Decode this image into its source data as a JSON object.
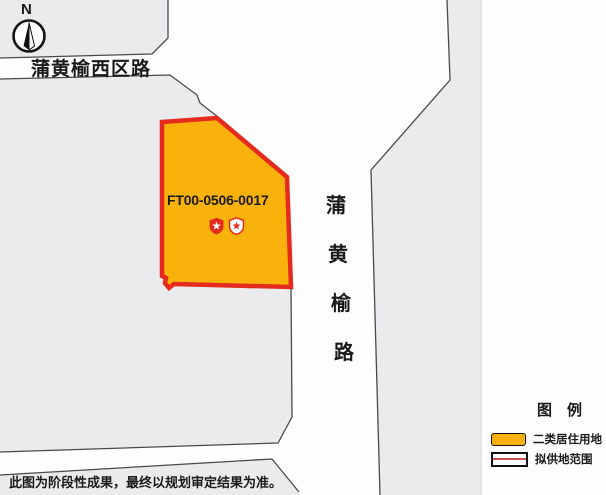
{
  "compass": {
    "north_label": "N"
  },
  "roads": {
    "west_district_road_label": "蒲黄榆西区路",
    "puhuangyu_road_chars": [
      "蒲",
      "黄",
      "榆",
      "路"
    ]
  },
  "parcel": {
    "code": "FT00-0506-0017"
  },
  "icons": {
    "compass": "north-compass-needle",
    "badge_left": "red-shield-white-star",
    "badge_right": "white-shield-red-star"
  },
  "legend": {
    "title": "图　例",
    "items": [
      {
        "label": "二类居住用地",
        "swatch": "orange-fill"
      },
      {
        "label": "拟供地范围",
        "swatch": "red-outline"
      }
    ]
  },
  "footnote": "此图为阶段性成果，最终以规划审定结果为准。",
  "colors": {
    "parcel_fill": "#F9B20C",
    "parcel_border": "#E52A1E",
    "block": "#EBEBED",
    "line": "#4A4A4A",
    "legend_line_red": "#C75050"
  }
}
